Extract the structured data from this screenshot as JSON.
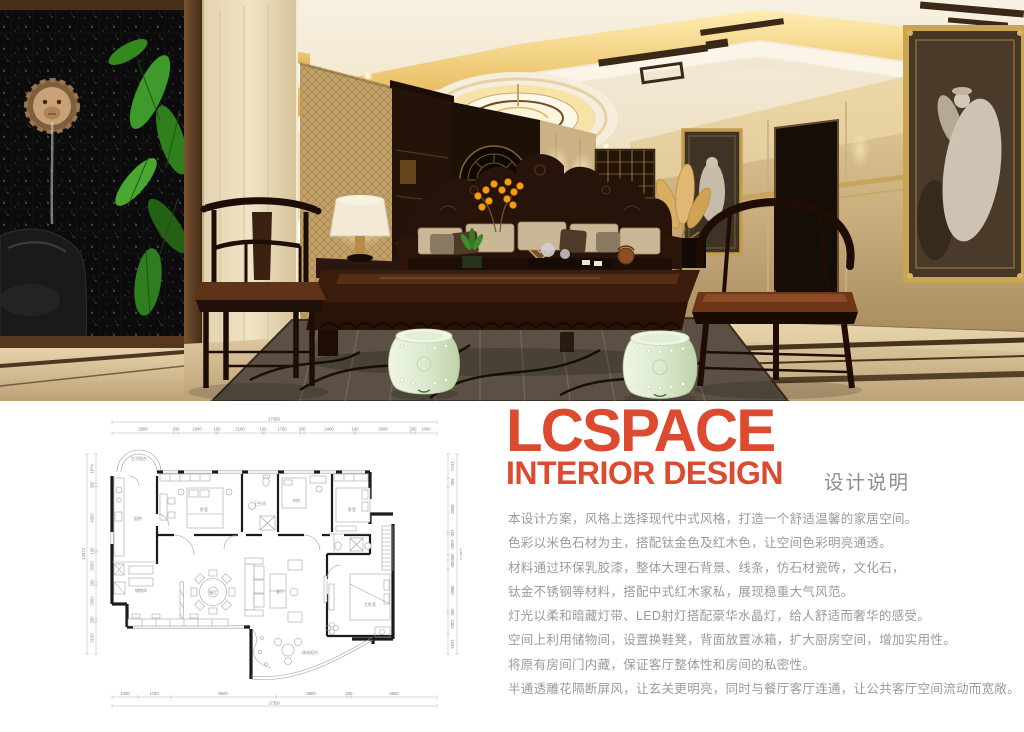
{
  "brand": {
    "name": "LCSPACE",
    "tagline": "INTERIOR DESIGN",
    "section_title": "设计说明",
    "accent_color": "#dc4a2f",
    "text_color": "#9a9a9a"
  },
  "design_notes": {
    "lines": [
      "本设计方案，风格上选择现代中式风格，打造一个舒适温馨的家居空间。",
      "色彩以米色石材为主，搭配钛金色及红木色，让空间色彩明亮通透。",
      "材料通过环保乳胶漆，整体大理石背景、线条，仿石材瓷砖，文化石，",
      "钛金不锈钢等材料，搭配中式红木家私，展现稳重大气风范。",
      "灯光以柔和暗藏灯带、LED射灯搭配豪华水晶灯，给人舒适而奢华的感受。",
      "空间上利用储物间，设置换鞋凳，背面放置冰箱，扩大厨房空间，增加实用性。",
      "将原有房间门内藏，保证客厅整体性和房间的私密性。",
      "半通透雕花隔断屏风，让玄关更明亮，同时与餐厅客厅连通，让公共客厅空间流动而宽敞。"
    ]
  },
  "floor_plan": {
    "top_total": "17350",
    "bottom_total": "17350",
    "side_total": "13974",
    "top_dims": [
      "2950",
      "200",
      "1800",
      "100",
      "2100",
      "100",
      "1700",
      "200",
      "2400",
      "100",
      "2600",
      "200",
      "1000"
    ],
    "bottom_dims": [
      "1400",
      "1750",
      "5600",
      "3800",
      "200",
      "4600"
    ],
    "left_dims": [
      "1974",
      "200",
      "4300",
      "100",
      "2000",
      "200",
      "2300",
      "200",
      "2100"
    ],
    "right_dims": [
      "1574",
      "600",
      "3000",
      "100",
      "1400",
      "300",
      "600",
      "2800",
      "200",
      "1304",
      "1294"
    ],
    "rooms": {
      "bay": "生活阳台",
      "kitchen": "厨房",
      "storage": "储物间",
      "bedroom1": "卧室",
      "bath": "卫生间",
      "study": "书房",
      "bedroom2": "卧室",
      "dining": "餐厅",
      "living": "客厅",
      "master": "主卧室",
      "balcony": "休闲阳台"
    }
  }
}
